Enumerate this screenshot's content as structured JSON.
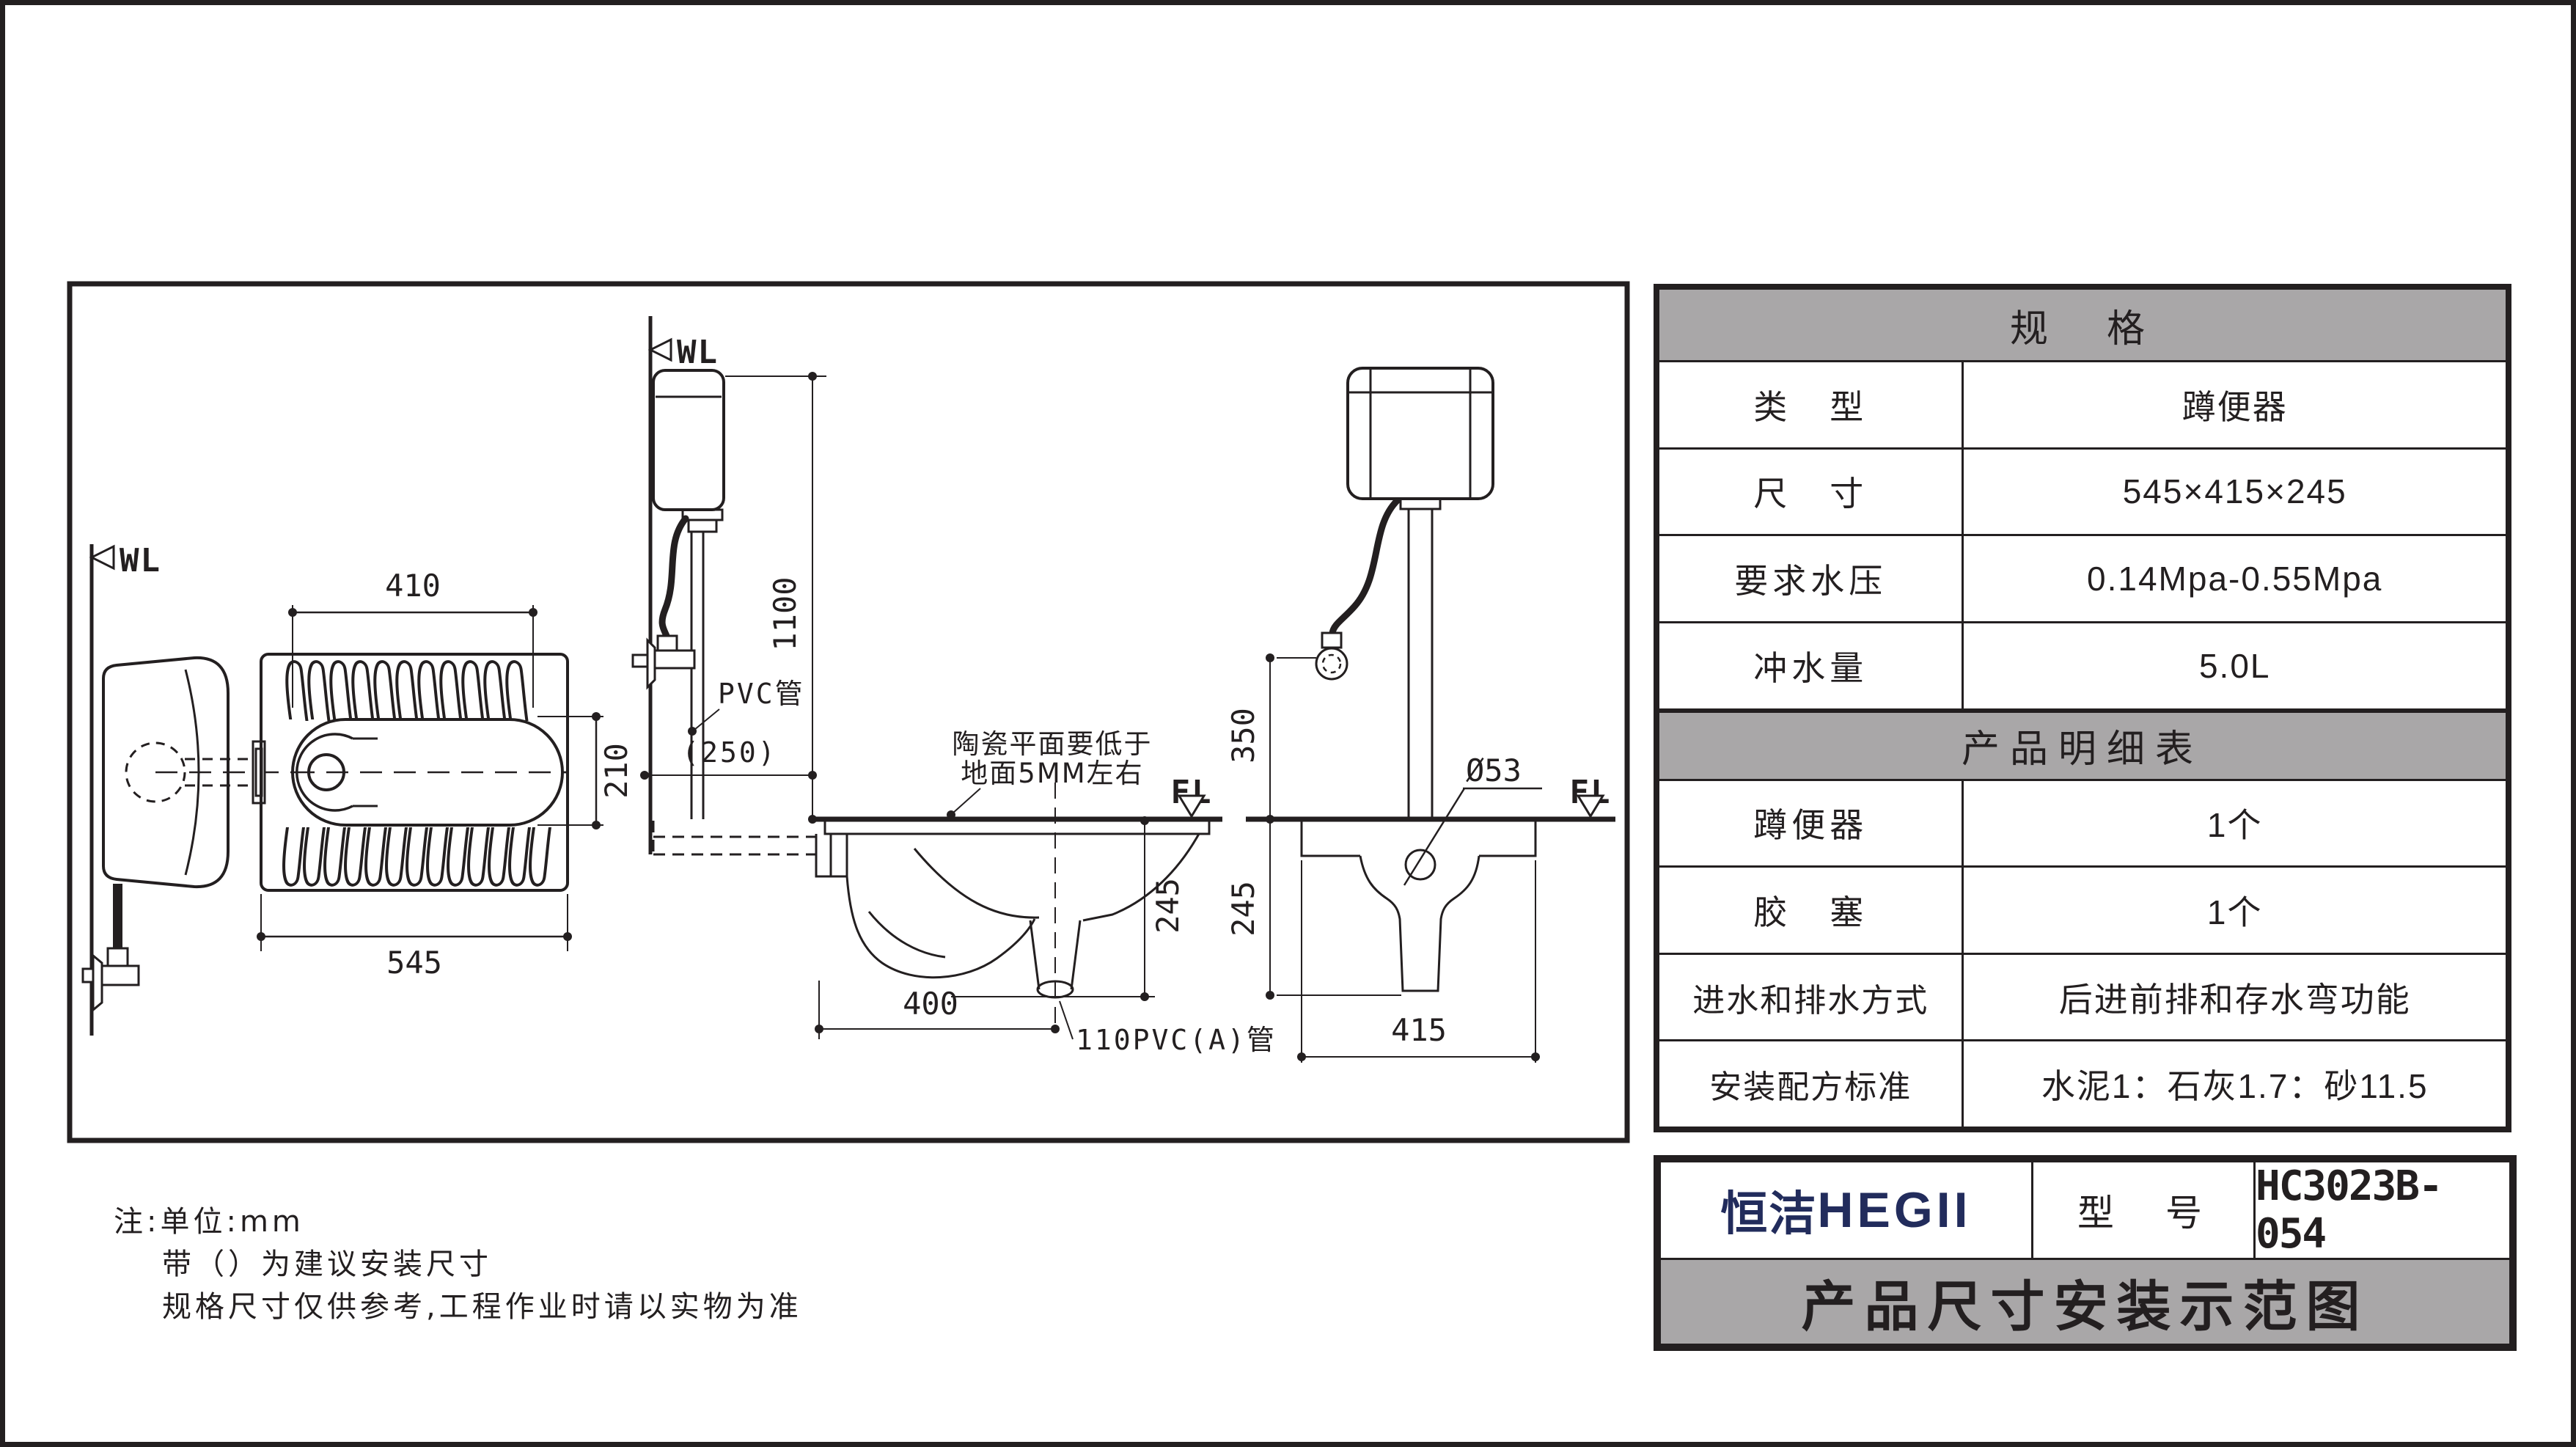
{
  "spec_table": {
    "title": "规　格",
    "rows": [
      {
        "label": "类　型",
        "value": "蹲便器"
      },
      {
        "label": "尺　寸",
        "value": "545×415×245"
      },
      {
        "label": "要求水压",
        "value": "0.14Mpa-0.55Mpa"
      },
      {
        "label": "冲水量",
        "value": "5.0L"
      }
    ]
  },
  "detail_table": {
    "title": "产品明细表",
    "rows": [
      {
        "label": "蹲便器",
        "value": "1个"
      },
      {
        "label": "胶　塞",
        "value": "1个"
      },
      {
        "label": "进水和排水方式",
        "value": "后进前排和存水弯功能"
      },
      {
        "label": "安装配方标准",
        "value": "水泥1：石灰1.7：砂11.5"
      }
    ]
  },
  "title_block": {
    "brand_cn": "恒洁",
    "brand_en": "HEGII",
    "model_label": "型　号",
    "model_value": "HC3023B-054",
    "banner": "产品尺寸安装示范图"
  },
  "notes": {
    "line1": "注:单位:mm",
    "line2": "带（）为建议安装尺寸",
    "line3": "规格尺寸仅供参考,工程作业时请以实物为准"
  },
  "drawing": {
    "wl_label": "WL",
    "fl_label": "FL",
    "top_view": {
      "dim_inner_width": "410",
      "dim_inner_depth": "210",
      "dim_width": "545"
    },
    "side_view": {
      "dim_height": "1100",
      "dim_wall_offset": "(250)",
      "pvc_pipe_label": "PVC管",
      "ceramic_note_line1": "陶瓷平面要低于",
      "ceramic_note_line2": "地面5MM左右",
      "dim_depth_below_floor": "245",
      "dim_outlet_offset": "400",
      "outlet_pipe_label": "110PVC(A)管"
    },
    "front_view": {
      "dim_inlet_height": "350",
      "dim_pipe_diameter": "Ø53",
      "dim_depth_below_floor": "245",
      "dim_width": "415"
    }
  },
  "colors": {
    "line": "#231f20",
    "header_gray": "#a9a7a8",
    "brand_navy": "#222c5c"
  }
}
